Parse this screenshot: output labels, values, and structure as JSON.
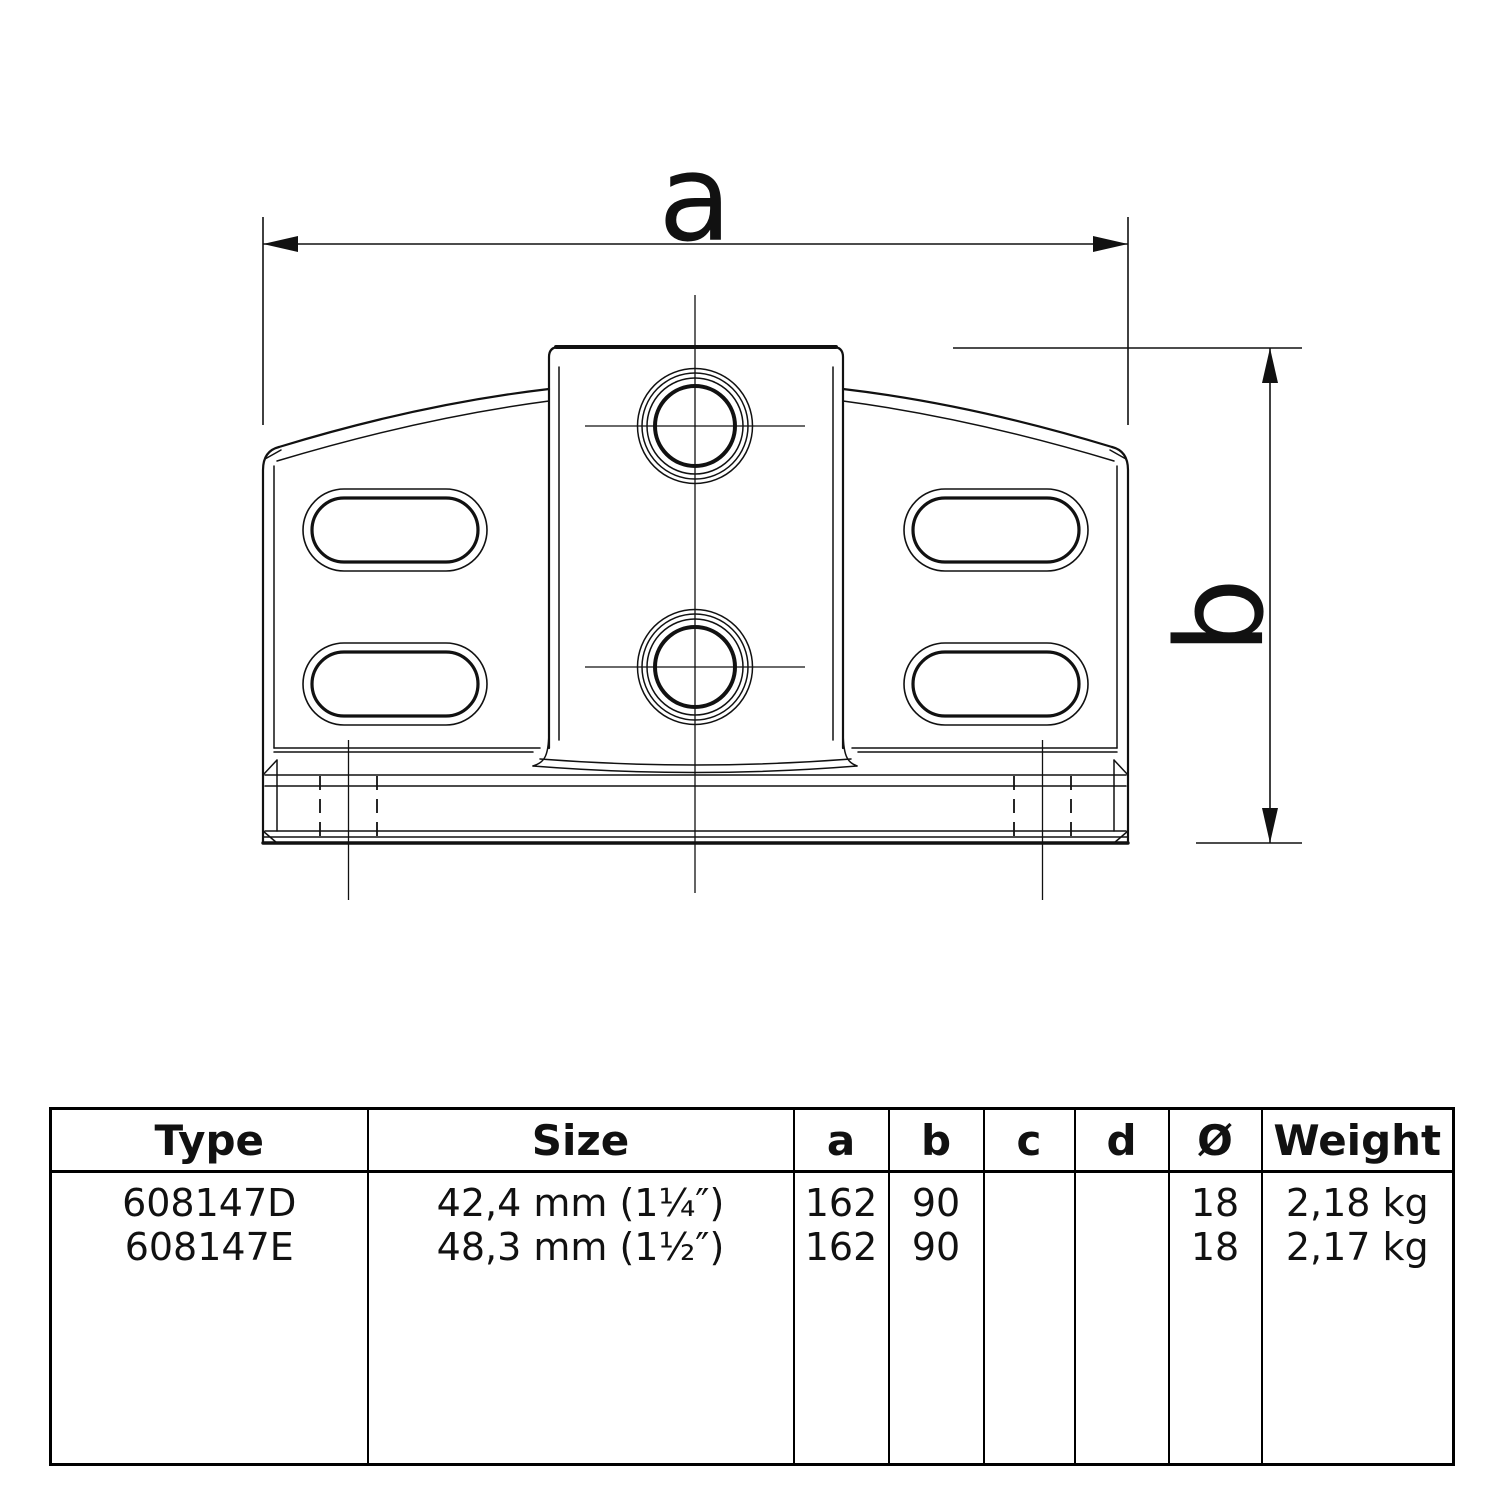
{
  "drawing": {
    "dim_a_label": "a",
    "dim_b_label": "b"
  },
  "table": {
    "headers": [
      "Type",
      "Size",
      "a",
      "b",
      "c",
      "d",
      "Ø",
      "Weight"
    ],
    "rows": [
      {
        "type": "608147D",
        "size": "42,4 mm (1¼″)",
        "a": "162",
        "b": "90",
        "c": "",
        "d": "",
        "diameter": "18",
        "weight": "2,18 kg"
      },
      {
        "type": "608147E",
        "size": "48,3 mm (1½″)",
        "a": "162",
        "b": "90",
        "c": "",
        "d": "",
        "diameter": "18",
        "weight": "2,17 kg"
      }
    ]
  },
  "colors": {
    "line": "#111111",
    "background": "#ffffff"
  }
}
